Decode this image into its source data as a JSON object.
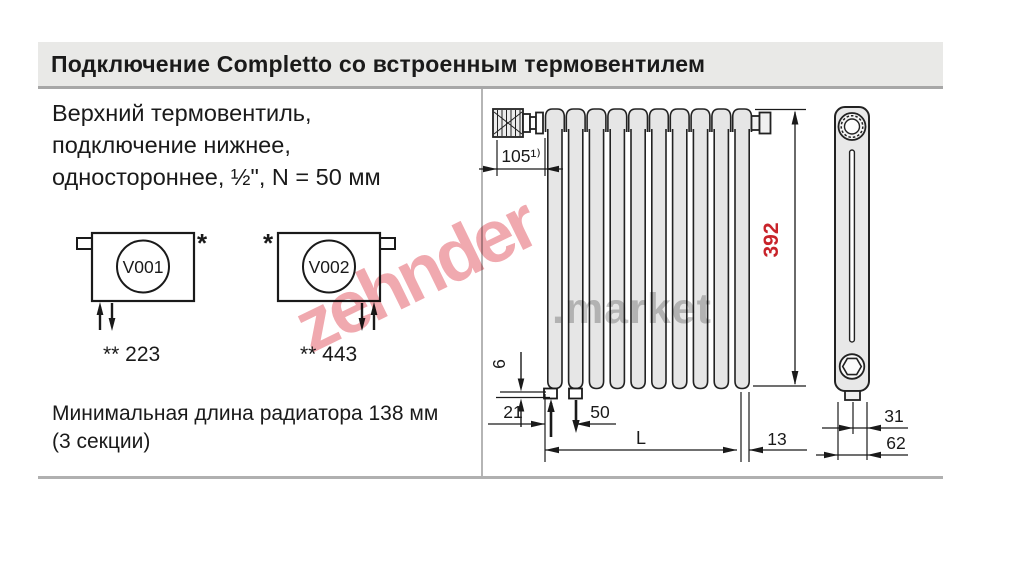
{
  "header": {
    "title": "Подключение Completto со встроенным термовентилем"
  },
  "left_panel": {
    "description": "Верхний термовентиль,\nподключение нижнее,\nодностороннее, ½\", N = 50 мм",
    "variants": [
      {
        "code": "V001",
        "note_mark": "*",
        "value_label": "** 223"
      },
      {
        "code": "V002",
        "note_mark": "*",
        "value_label": "** 443"
      }
    ],
    "footnote": "Минимальная длина радиатора 138 мм\n(3 секции)"
  },
  "drawing": {
    "dimensions": {
      "valve_offset": "105¹⁾",
      "height": "392",
      "bottom_gap": "6",
      "edge_to_connection": "21",
      "connection_pitch": "50",
      "length": "L",
      "edge_offset": "13",
      "depth_half": "31",
      "depth_total": "62"
    },
    "colors": {
      "dimension_red": "#c8232a",
      "line": "#1a1a1a",
      "radiator_fill": "#e6e6e6"
    }
  },
  "watermark": {
    "part1": "zehnder",
    "part2": ".market",
    "pink": "#f0a9af",
    "gray": "#c6c6c6"
  },
  "page": {
    "header_bg": "#e9e9e7"
  }
}
